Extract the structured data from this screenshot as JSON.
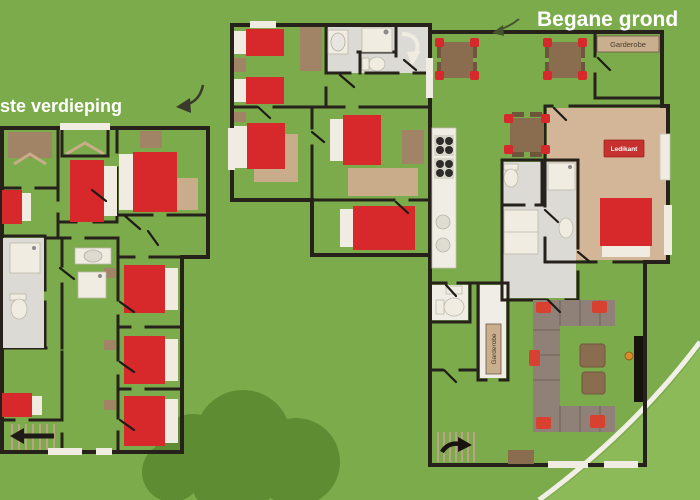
{
  "titles": {
    "ground_floor": "Begane grond",
    "first_floor": "ste verdieping"
  },
  "labels": {
    "wardrobe_room": "Garderobe",
    "wardrobe_closet": "Garderobe",
    "cot": "Ledikant"
  },
  "icons": {
    "first_floor_pointer": "curved-arrow-down-left",
    "ground_floor_pointer": "curved-arrow-down-left",
    "stairs_first_floor": "arrow-left",
    "stairs_ground_floor": "curved-arrow-right",
    "spiral_stairs": "curved-arrow-down"
  },
  "colors": {
    "grass": "#7CAB4B",
    "bush_dark": "#5E8C33",
    "grass_light": "#8CBA58",
    "path_white": "#F2EFE7",
    "floor_tan": "#D8BF9F",
    "floor_dark": "#C9AD8A",
    "wall_dark": "#26211B",
    "bed_red": "#D7282B",
    "linen_white": "#F1ECE1",
    "bathroom_gray": "#DBDAD5",
    "furniture_brown": "#8A6C4E",
    "wardrobe_brown": "#A18365",
    "sofa_taupe": "#8F8078",
    "accent_orange": "#D98A2B",
    "title_white": "#FFFFFF"
  }
}
